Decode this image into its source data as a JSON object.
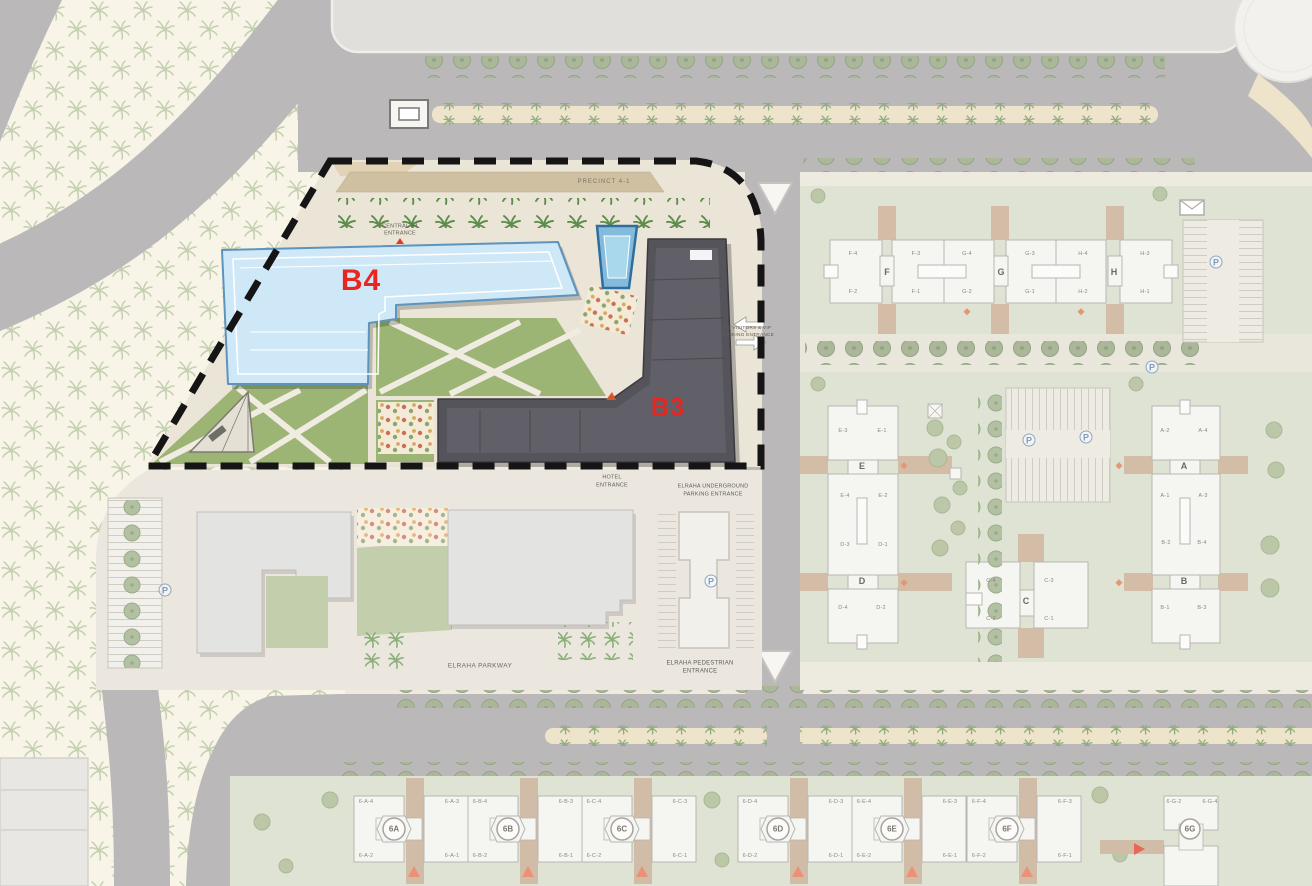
{
  "map_title": "Residential master plan with highlighted parcels B3 and B4",
  "parcels": {
    "b4_label": "B4",
    "b3_label": "B3"
  },
  "notes": {
    "precinct": "PRECINCT 4-1",
    "north_entrance_l1": "CENTRAL B4",
    "north_entrance_l2": "ENTRANCE",
    "east_entrance_l1": "B3 VISITORS & VIP",
    "east_entrance_l2": "PARKING ENTRANCE",
    "south_entrance_l1": "HOTEL",
    "south_entrance_l2": "ENTRANCE",
    "underground_l1": "ELRAHA UNDERGROUND",
    "underground_l2": "PARKING ENTRANCE",
    "parkway": "ELRAHA PARKWAY",
    "pedestrian_l1": "ELRAHA PEDESTRIAN",
    "pedestrian_l2": "ENTRANCE",
    "parking_symbol": "P"
  },
  "precincts": {
    "north_row": {
      "letters": [
        "F",
        "G",
        "H"
      ],
      "units_top": [
        "F-4",
        "F-3",
        "G-4",
        "G-3",
        "H-4",
        "H-3"
      ],
      "units_bottom": [
        "F-2",
        "F-1",
        "G-2",
        "G-1",
        "H-2",
        "H-1"
      ]
    },
    "west_column": {
      "letters": [
        "E",
        "D"
      ],
      "units": [
        [
          "E-3",
          "E-1"
        ],
        [
          "E-4",
          "E-2"
        ],
        [
          "D-3",
          "D-1"
        ],
        [
          "D-4",
          "D-2"
        ]
      ]
    },
    "east_column": {
      "letters": [
        "A",
        "B"
      ],
      "units": [
        [
          "A-2",
          "A-4"
        ],
        [
          "A-1",
          "A-3"
        ],
        [
          "B-2",
          "B-4"
        ],
        [
          "B-1",
          "B-3"
        ]
      ]
    },
    "c_building": {
      "letter": "C",
      "units_top": [
        "C-4",
        "C-3"
      ],
      "units_bottom": [
        "C-2",
        "C-1"
      ]
    }
  },
  "south_row": [
    {
      "badge": "6A",
      "units": [
        "6-A-4",
        "6-A-3",
        "6-A-2",
        "6-A-1"
      ]
    },
    {
      "badge": "6B",
      "units": [
        "6-B-4",
        "6-B-3",
        "6-B-2",
        "6-B-1"
      ]
    },
    {
      "badge": "6C",
      "units": [
        "6-C-4",
        "6-C-3",
        "6-C-2",
        "6-C-1"
      ]
    },
    {
      "badge": "6D",
      "units": [
        "6-D-4",
        "6-D-3",
        "6-D-2",
        "6-D-1"
      ]
    },
    {
      "badge": "6E",
      "units": [
        "6-E-4",
        "6-E-3",
        "6-E-2",
        "6-E-1"
      ]
    },
    {
      "badge": "6F",
      "units": [
        "6-F-4",
        "6-F-3",
        "6-F-2",
        "6-F-1"
      ]
    },
    {
      "badge": "6G",
      "units": [
        "6-G-2",
        "6-G-4"
      ]
    }
  ],
  "colors": {
    "b4_fill": "#cfe8f8",
    "b3_fill": "#55545a",
    "label_red": "#e8251f",
    "road": "#a8a5a7",
    "lawn_highlight": "#9cb474",
    "lawn_faded": "#d7dcc8",
    "boundary_dash": "#151515",
    "pool_blue": "#84bbdd"
  }
}
